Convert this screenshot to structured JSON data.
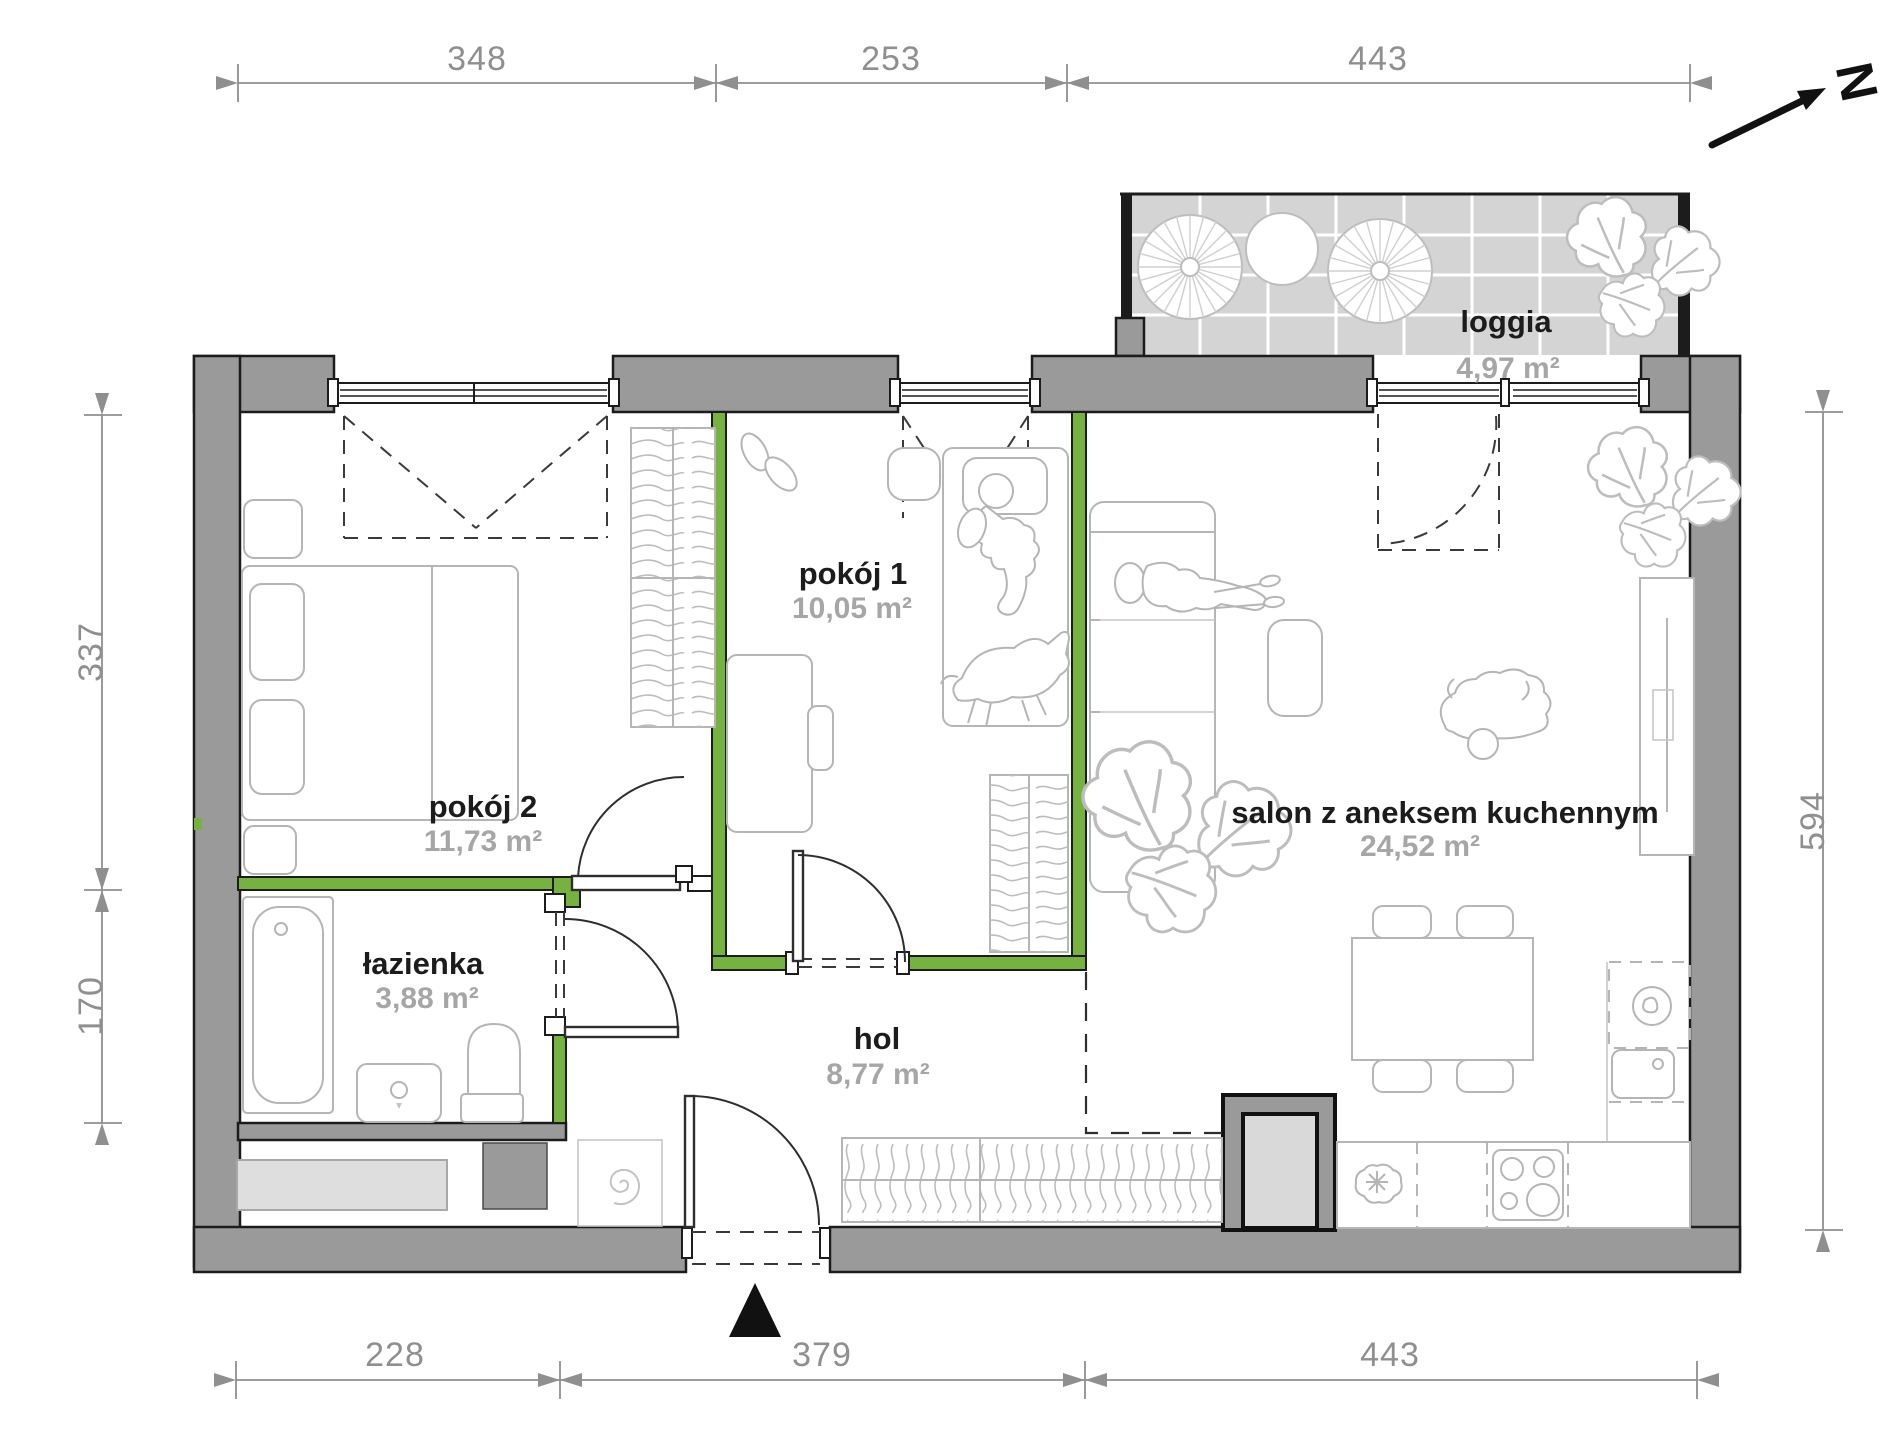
{
  "plan": {
    "type": "apartment-floor-plan",
    "rooms": [
      {
        "id": "pokoj2",
        "name": "pokój 2",
        "area": "11,73 m²"
      },
      {
        "id": "pokoj1",
        "name": "pokój 1",
        "area": "10,05 m²"
      },
      {
        "id": "lazienka",
        "name": "łazienka",
        "area": "3,88 m²"
      },
      {
        "id": "hol",
        "name": "hol",
        "area": "8,77 m²"
      },
      {
        "id": "salon",
        "name": "salon z aneksem kuchennym",
        "area": "24,52 m²"
      },
      {
        "id": "loggia",
        "name": "loggia",
        "area": "4,97 m²"
      }
    ],
    "dimensions_cm": {
      "top": [
        "348",
        "253",
        "443"
      ],
      "bottom": [
        "228",
        "379",
        "443"
      ],
      "left": [
        "337",
        "170"
      ],
      "right": [
        "594"
      ]
    },
    "north": {
      "label": "N"
    },
    "icons": {
      "north_arrow": "north-arrow-icon",
      "entrance_marker": "entrance-triangle-icon"
    },
    "colors": {
      "wall_gray": "#9a9a9a",
      "accent_green": "#76b33e",
      "loggia_floor": "#d4d4d4",
      "shaft_fill": "#d9d9d9",
      "dimension_gray": "#8f8f8f",
      "furniture_line": "#b5b5b5",
      "room_name_text": "#1c1c1c",
      "room_area_text": "#a6a6a6",
      "outline_black": "#1c1c1c"
    }
  }
}
